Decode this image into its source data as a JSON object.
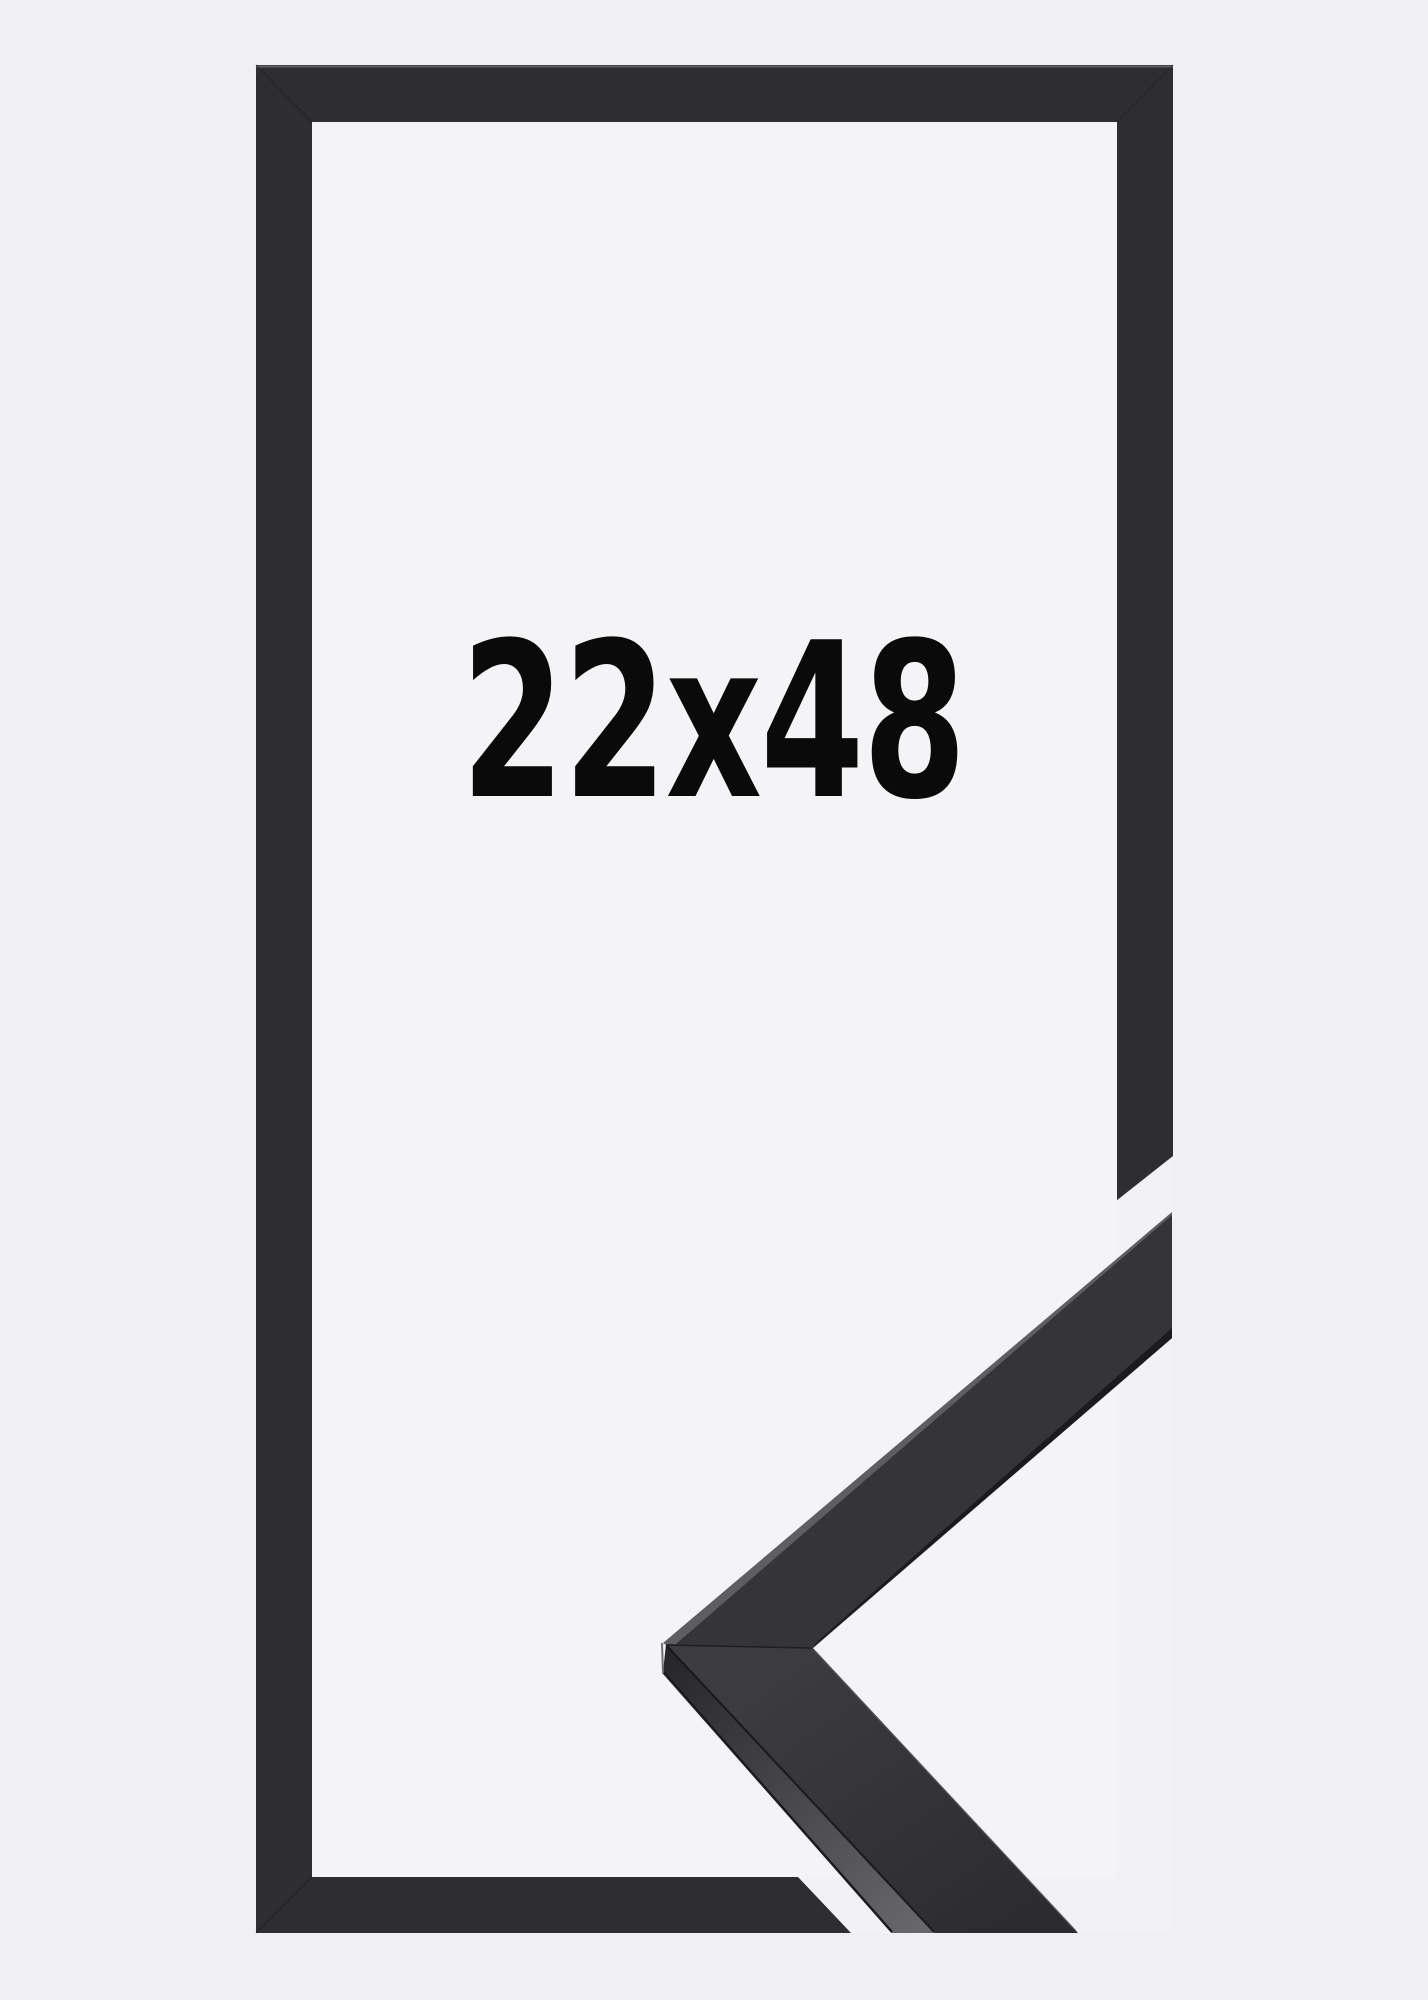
{
  "product_image": {
    "size_label": "22x48",
    "label_color": "#0a0a0a",
    "colors": {
      "background": "#f0f0f2",
      "window": "#f4f4f6",
      "gap": "#f2f2f4",
      "frame": "#2e2e30",
      "frame_seam": "#1c1c1d",
      "frame_top_highlight": "#9a9a9d",
      "moulding_front_upper": "#353538",
      "moulding_front_lower_start": "#3c3c3e",
      "moulding_front_lower_end": "#2c2c2e",
      "moulding_side_start": "#252527",
      "moulding_side_end": "#67676a",
      "moulding_edge_highlight": "#5e5e61",
      "moulding_lip": "#1b1b1d",
      "moulding_seam": "#19191b",
      "moulding_face_seam": "#151517",
      "moulding_outer_edge": "#131315",
      "moulding_tip_edge": "#707073",
      "moulding_top_light": "#58585b"
    }
  }
}
